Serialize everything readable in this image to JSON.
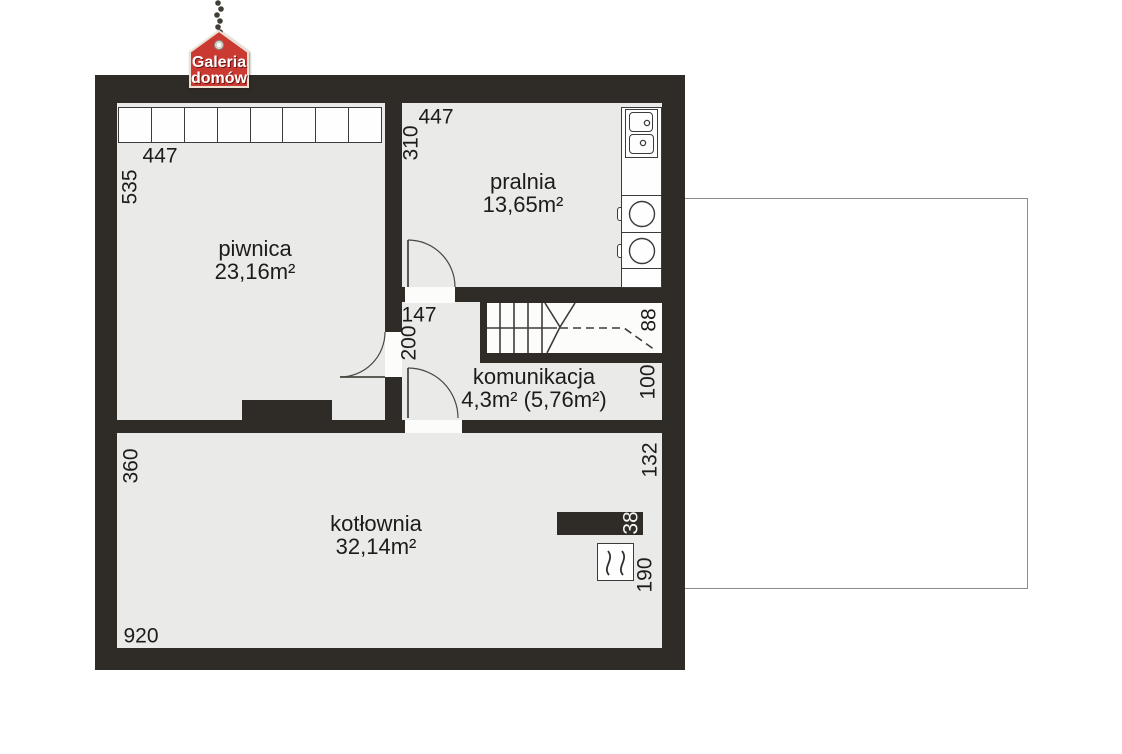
{
  "logo": {
    "line1": "Galeria",
    "line2": "domów"
  },
  "rooms": {
    "piwnica": {
      "name": "piwnica",
      "area": "23,16m²"
    },
    "pralnia": {
      "name": "pralnia",
      "area": "13,65m²"
    },
    "komunikacja": {
      "name": "komunikacja",
      "area": "4,3m² (5,76m²)"
    },
    "kotlownia": {
      "name": "kotłownia",
      "area": "32,14m²"
    }
  },
  "dims": {
    "piwnica_w": "447",
    "piwnica_h": "535",
    "pralnia_w": "447",
    "pralnia_h": "310",
    "hall_w": "147",
    "hall_h": "200",
    "stair_w": "88",
    "kom_h": "100",
    "kot_right": "132",
    "chimney_w": "38",
    "boiler_d": "190",
    "kot_h": "360",
    "kot_w": "920"
  },
  "colors": {
    "wall": "#2f2b27",
    "room_fill": "#eaeae8",
    "accent_red": "#ca3a33",
    "annex_border": "#8b8b8b"
  }
}
